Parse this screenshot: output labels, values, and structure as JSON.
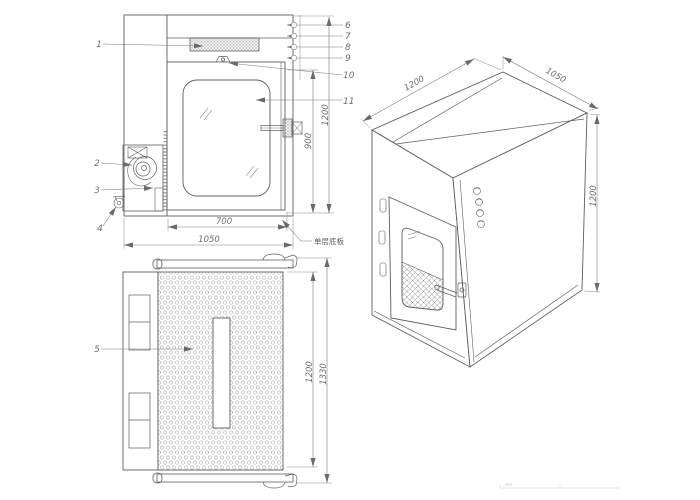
{
  "front_view": {
    "labels": {
      "n1": "1",
      "n2": "2",
      "n3": "3",
      "n4": "4",
      "n6": "6",
      "n7": "7",
      "n8": "8",
      "n9": "9",
      "n10": "10",
      "n11": "11"
    },
    "dims": {
      "door_width": "700",
      "overall_width": "1050",
      "door_height": "900",
      "overall_height": "1200"
    },
    "note_bottom_plate": "单层底板"
  },
  "back_view": {
    "labels": {
      "n5": "5"
    },
    "dims": {
      "body_height": "1200",
      "overall_height": "1330"
    }
  },
  "iso_view": {
    "dims": {
      "depth": "1200",
      "width": "1050",
      "height": "1200"
    }
  }
}
